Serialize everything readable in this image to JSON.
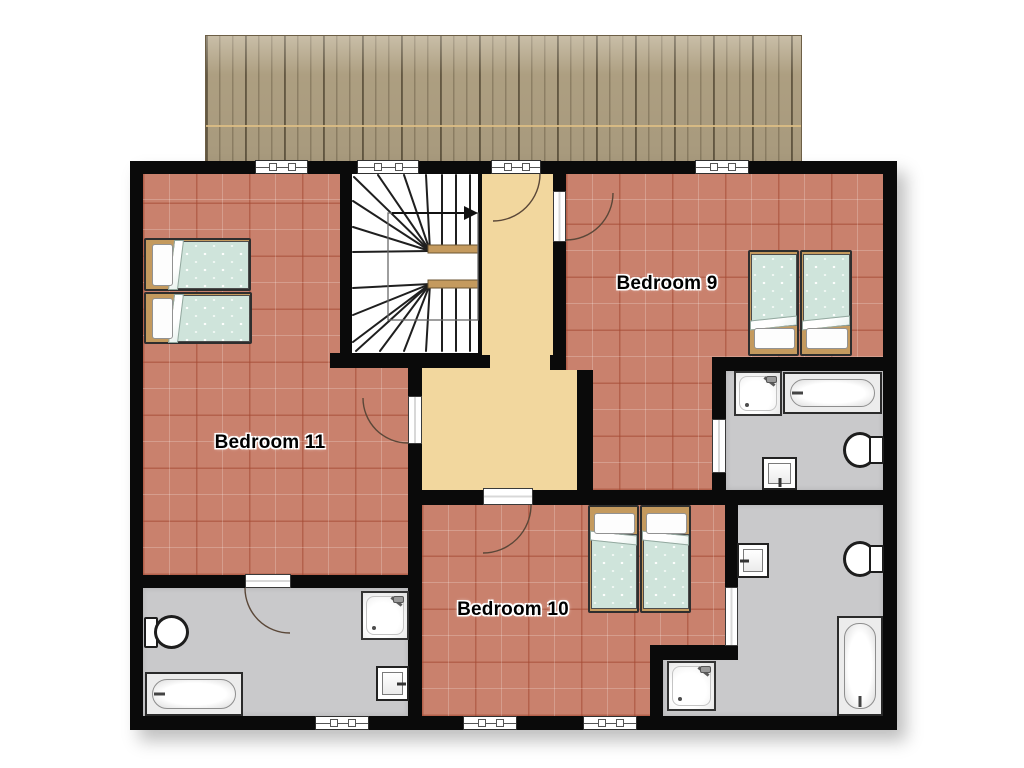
{
  "labels": {
    "bedroom9": "Bedroom 9",
    "bedroom10": "Bedroom 10",
    "bedroom11": "Bedroom 11"
  },
  "palette": {
    "wall": "#0a0a0a",
    "bedroom-floor": "#c9816d",
    "hall-floor": "#f2d79e",
    "bath-floor": "#c9c9cb",
    "roof": "#b4a586",
    "wood": "#c49a5e",
    "duvet": "#cfe4db"
  },
  "icons": {
    "stairs_direction": "up-arrow-right"
  }
}
